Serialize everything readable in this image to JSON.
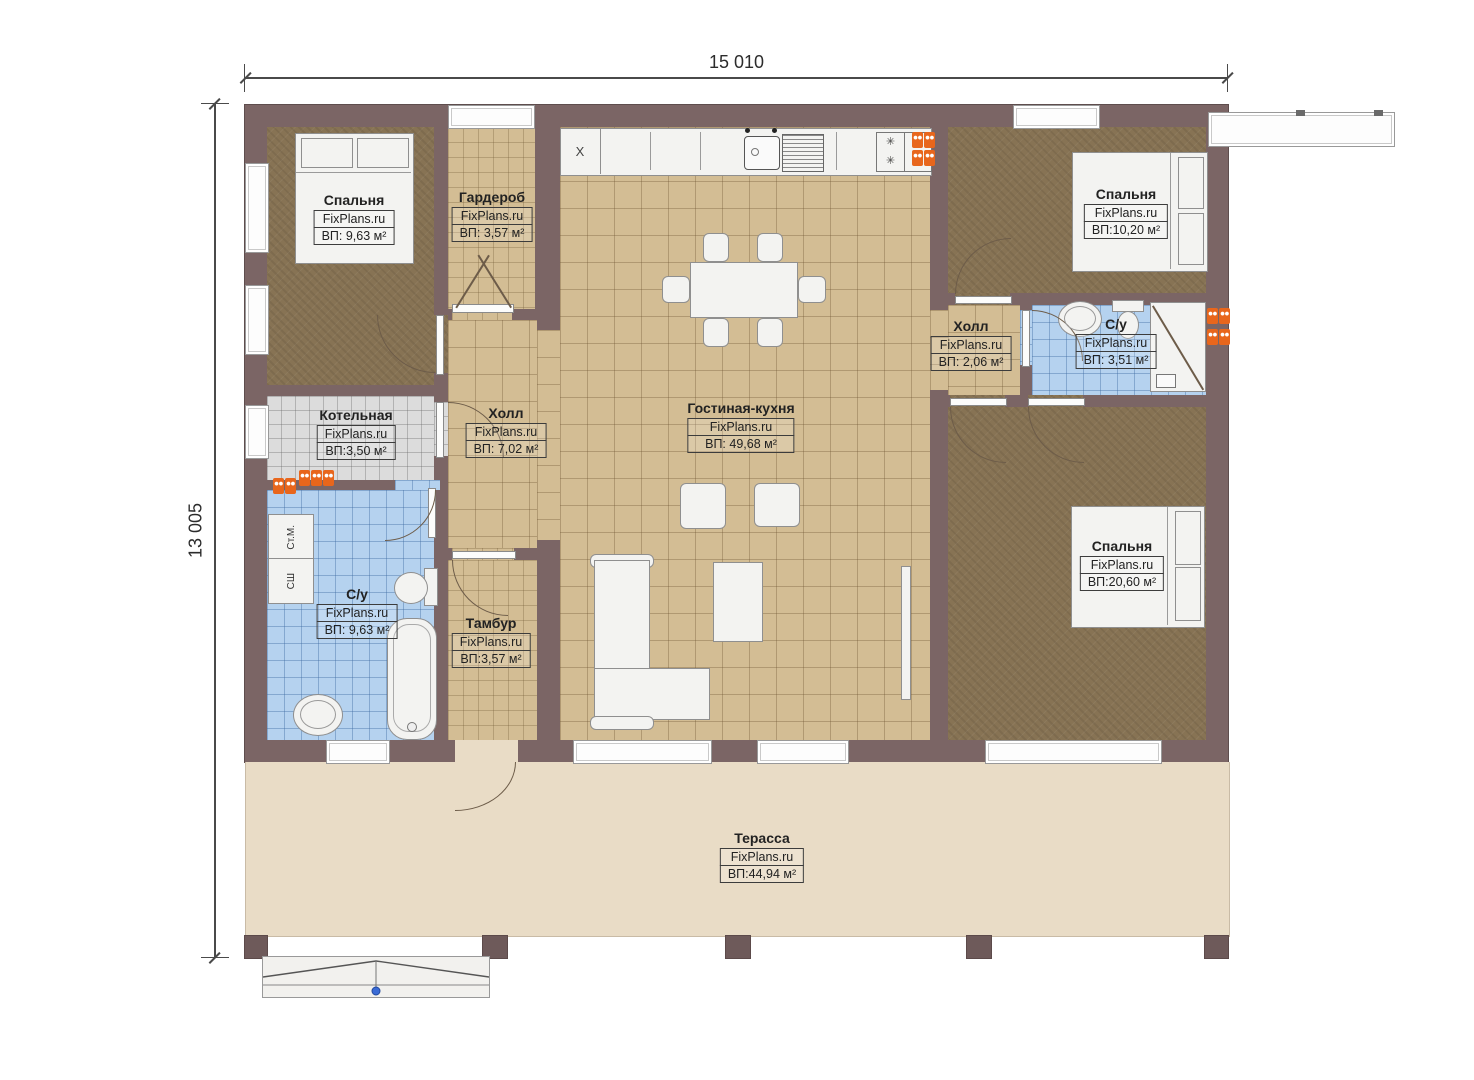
{
  "dimensions": {
    "width": "15 010",
    "height": "13 005"
  },
  "brand": "FixPlans.ru",
  "rooms": [
    {
      "name": "Спальня",
      "brand": "FixPlans.ru",
      "area": "ВП: 9,63 м²"
    },
    {
      "name": "Гардероб",
      "brand": "FixPlans.ru",
      "area": "ВП: 3,57 м²"
    },
    {
      "name": "Спальня",
      "brand": "FixPlans.ru",
      "area": "ВП:10,20 м²"
    },
    {
      "name": "Холл",
      "brand": "FixPlans.ru",
      "area": "ВП: 2,06 м²"
    },
    {
      "name": "С/у",
      "brand": "FixPlans.ru",
      "area": "ВП: 3,51 м²"
    },
    {
      "name": "Котельная",
      "brand": "FixPlans.ru",
      "area": "ВП:3,50 м²"
    },
    {
      "name": "Холл",
      "brand": "FixPlans.ru",
      "area": "ВП: 7,02 м²"
    },
    {
      "name": "Гостиная-кухня",
      "brand": "FixPlans.ru",
      "area": "ВП: 49,68 м²"
    },
    {
      "name": "С/у",
      "brand": "FixPlans.ru",
      "area": "ВП: 9,63 м²"
    },
    {
      "name": "Тамбур",
      "brand": "FixPlans.ru",
      "area": "ВП:3,57 м²"
    },
    {
      "name": "Спальня",
      "brand": "FixPlans.ru",
      "area": "ВП:20,60 м²"
    },
    {
      "name": "Терасса",
      "brand": "FixPlans.ru",
      "area": "ВП:44,94 м²"
    }
  ],
  "appliances": {
    "washing_machine": "Ст.М.",
    "dryer_cabinet": "СШ",
    "kitchen_unit_x": "X"
  },
  "icons": {
    "burner": "✳"
  },
  "colors": {
    "wall": "#7b6565",
    "wood_floor": "#877354",
    "tile_beige": "#d3bd94",
    "tile_blue": "#b5d2ef",
    "tile_gray": "#dcdcdc",
    "terrace": "#e9dcc6",
    "radiator": "#e8661c",
    "marker_blue": "#3a6bd6"
  }
}
